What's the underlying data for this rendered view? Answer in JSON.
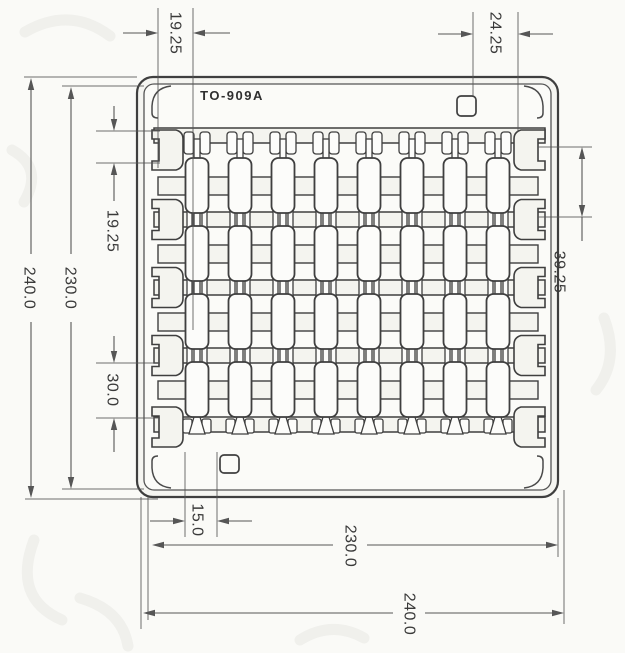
{
  "drawing": {
    "title": "TO-909A",
    "matrix": {
      "rows": 4,
      "cols": 8
    },
    "dimensions": {
      "top_left": "19.25",
      "top_right": "24.25",
      "left_outer": "240.0",
      "left_inner": "230.0",
      "left_offset": "19.25",
      "left_pitch": "30.0",
      "right_pitch": "39.25",
      "bottom_lead": "15.0",
      "bottom_inner": "230.0",
      "bottom_outer": "240.0"
    },
    "colors": {
      "line": "#3f3f3f",
      "dim_line": "#565656",
      "text": "#3a3a3a",
      "paper": "#fafaf7",
      "fill_frame": "#f5f5f1",
      "fill_inner": "#fbfbf8",
      "fill_strip": "#f4f4ef",
      "fill_unit": "#fcfcfa",
      "watermark": "#c2c2ba"
    }
  }
}
